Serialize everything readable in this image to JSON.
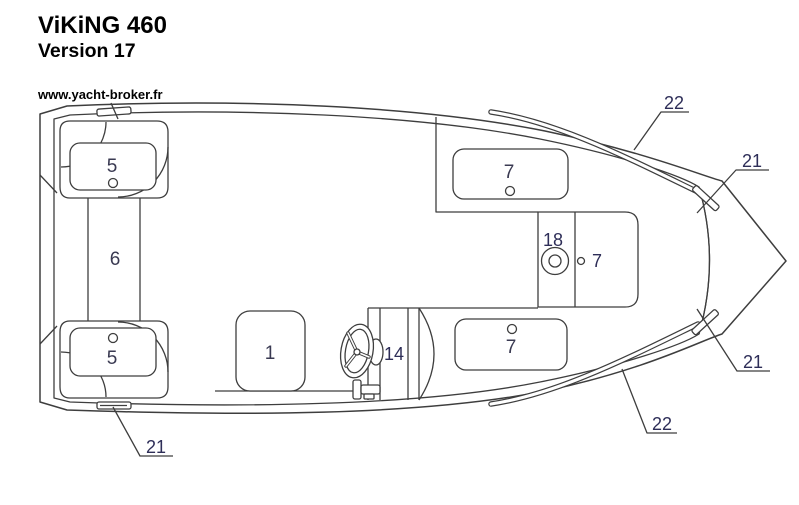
{
  "header": {
    "title": "ViKiNG 460",
    "subtitle": "Version 17",
    "website": "www.yacht-broker.fr"
  },
  "diagram": {
    "description": "Top-view deck plan of the ViKiNG 460 boat, version 17, with numbered parts",
    "part_labels": {
      "seat5_top": "5",
      "seat5_bottom": "5",
      "passage6": "6",
      "seat1": "1",
      "steering14": "14",
      "seat7_top": "7",
      "fitting18": "18",
      "seat7_mid": "7",
      "seat7_bottom": "7"
    },
    "callouts": {
      "rail_top": "22",
      "cleat_top_right": "21",
      "cleat_bottom_right": "21",
      "rail_bottom": "22",
      "cleat_bottom_left": "21"
    }
  },
  "theme": {
    "bg": "#ffffff",
    "line": "#3e3e3e",
    "number": "#3a3a52",
    "callout": "#2e2e58",
    "title": "#000000"
  }
}
